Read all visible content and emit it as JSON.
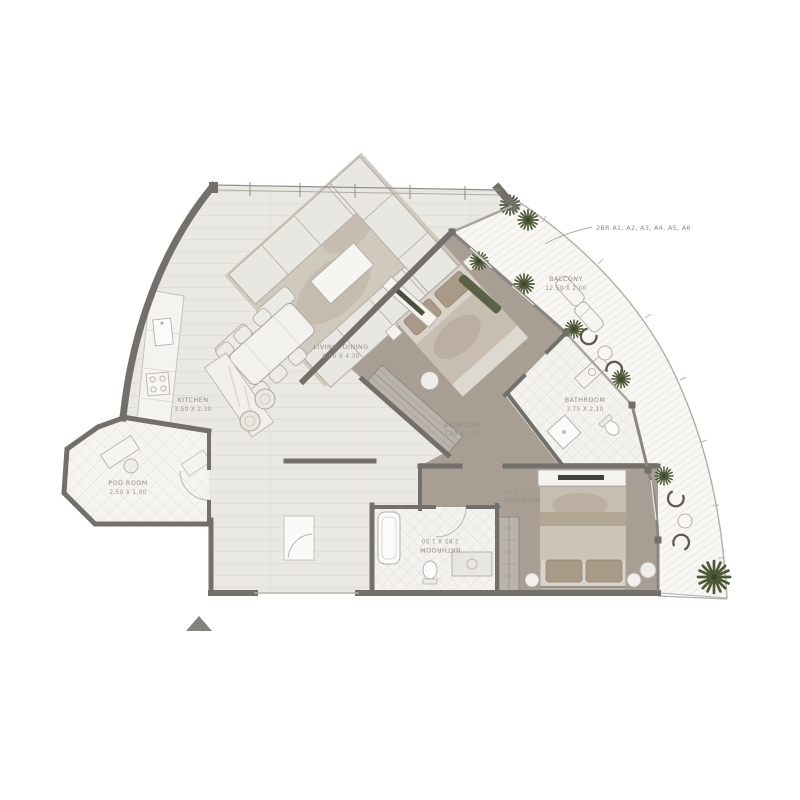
{
  "plan": {
    "callout": {
      "label": "2BR A1, A2, A3, A4, A5, A6"
    },
    "rooms": [
      {
        "id": "balcony",
        "name": "BALCONY",
        "dims": "12.50 X 2.00"
      },
      {
        "id": "living-dining",
        "name": "LIVING/ DINING",
        "dims": "8.90 X 4.30"
      },
      {
        "id": "kitchen",
        "name": "KITCHEN",
        "dims": "3.50 X 2.30"
      },
      {
        "id": "pod-room",
        "name": "POD ROOM",
        "dims": "2.50 X 1.90"
      },
      {
        "id": "bedroom-1",
        "name": "BEDROOM",
        "dims": "3.80 X 3.05"
      },
      {
        "id": "bathroom-1",
        "name": "BATHROOM",
        "dims": "3.75 X 2.10"
      },
      {
        "id": "bedroom-2",
        "name": "BEDROOM",
        "dims": "3.70 X 3.00"
      },
      {
        "id": "bathroom-2",
        "name": "BATHROOM",
        "dims": "2.85 X 1.50"
      }
    ],
    "colors": {
      "wall": "#73706b",
      "living_floor": "#eae8e2",
      "bedroom_floor": "#a89e94",
      "bathroom_floor": "#f3f2ee",
      "balcony_floor": "#f8f7f3",
      "palm_green": "#4d5837",
      "label_text": "#938e88"
    }
  }
}
